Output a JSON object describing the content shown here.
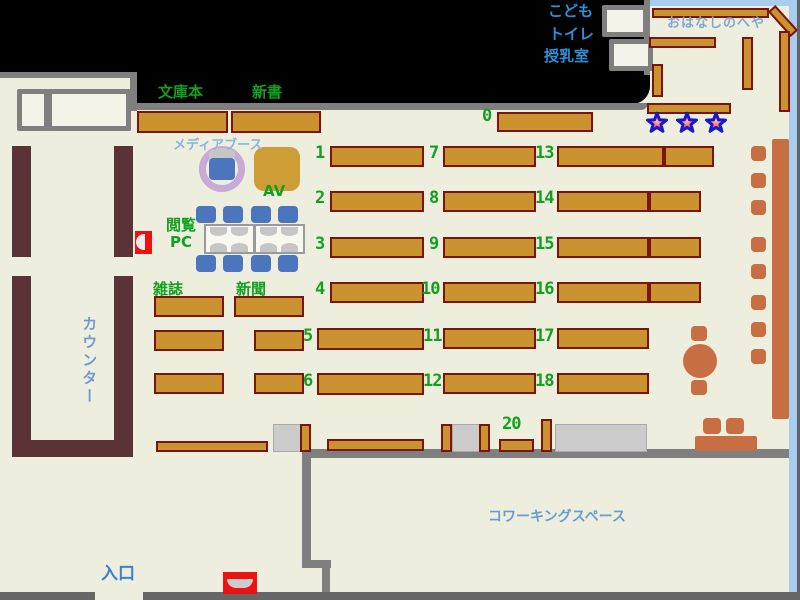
{
  "title": "library-floor-map",
  "colors": {
    "floor": "#eeeede",
    "outside": "#000000",
    "wall_gray": "#7f7f7f",
    "wall_dark": "#666666",
    "story_border_blue": "#a9cdee",
    "shelf_fill": "#ca9330",
    "shelf_border": "#7a150c",
    "counter_maroon": "#5b3336",
    "terracotta": "#c76f42",
    "chair_blue": "#4b76bd",
    "label_green": "#12a01f",
    "label_blue": "#3c7fd8",
    "label_midblue": "#6b9bd2",
    "label_story": "#7fa8d0",
    "label_toilet": "#2f8fd6",
    "media_ring_purple": "#c9a9d6",
    "red_box": "#ee1111",
    "star_fill": "#dd2233",
    "star_stroke": "#1818cc",
    "gray_box": "#cbcbcb"
  },
  "labels": [
    {
      "name": "label-kodomo",
      "text": "こども",
      "x": 548,
      "y": 3,
      "cls": "tblue"
    },
    {
      "name": "label-toilet",
      "text": "トイレ",
      "x": 549,
      "y": 26,
      "cls": "tblue"
    },
    {
      "name": "label-nursing-room",
      "text": "授乳室",
      "x": 544,
      "y": 48,
      "cls": "tblue"
    },
    {
      "name": "label-story-room",
      "text": "おはなしのへや",
      "x": 667,
      "y": 17,
      "cls": "story"
    },
    {
      "name": "label-paperbacks",
      "text": "文庫本",
      "x": 158,
      "y": 84,
      "cls": "green"
    },
    {
      "name": "label-new-books",
      "text": "新書",
      "x": 252,
      "y": 84,
      "cls": "green"
    },
    {
      "name": "label-media-booth",
      "text": "メディアブース",
      "x": 173,
      "y": 139,
      "cls": "media"
    },
    {
      "name": "label-av",
      "text": "AV",
      "x": 263,
      "y": 183,
      "cls": "green"
    },
    {
      "name": "label-browsing-pc",
      "text": "閲覧\nPC",
      "x": 166,
      "y": 217,
      "cls": "green pcl"
    },
    {
      "name": "label-magazines",
      "text": "雑誌",
      "x": 153,
      "y": 281,
      "cls": "green"
    },
    {
      "name": "label-newspapers",
      "text": "新聞",
      "x": 236,
      "y": 281,
      "cls": "green"
    },
    {
      "name": "label-counter",
      "text": "カウンター",
      "x": 80,
      "y": 316,
      "cls": "mblue vert",
      "size": 15
    },
    {
      "name": "label-entrance",
      "text": "入口",
      "x": 101,
      "y": 565,
      "cls": "blue big"
    },
    {
      "name": "label-coworking",
      "text": "コワーキングスペース",
      "x": 488,
      "y": 509,
      "cls": "mblue",
      "size": 14
    }
  ],
  "shelf_numbers": [
    {
      "n": "0",
      "x": 482,
      "y": 106
    },
    {
      "n": "1",
      "x": 315,
      "y": 143
    },
    {
      "n": "2",
      "x": 315,
      "y": 188
    },
    {
      "n": "3",
      "x": 315,
      "y": 234
    },
    {
      "n": "4",
      "x": 315,
      "y": 279
    },
    {
      "n": "5",
      "x": 303,
      "y": 326
    },
    {
      "n": "6",
      "x": 303,
      "y": 371
    },
    {
      "n": "7",
      "x": 429,
      "y": 143
    },
    {
      "n": "8",
      "x": 429,
      "y": 188
    },
    {
      "n": "9",
      "x": 429,
      "y": 234
    },
    {
      "n": "10",
      "x": 421,
      "y": 279
    },
    {
      "n": "11",
      "x": 423,
      "y": 326
    },
    {
      "n": "12",
      "x": 423,
      "y": 371
    },
    {
      "n": "13",
      "x": 535,
      "y": 143
    },
    {
      "n": "14",
      "x": 535,
      "y": 188
    },
    {
      "n": "15",
      "x": 535,
      "y": 234
    },
    {
      "n": "16",
      "x": 535,
      "y": 279
    },
    {
      "n": "17",
      "x": 535,
      "y": 326
    },
    {
      "n": "18",
      "x": 535,
      "y": 371
    },
    {
      "n": "20",
      "x": 502,
      "y": 414
    }
  ],
  "map_shapes": {
    "gold_shelves": [
      {
        "x": 137,
        "y": 111,
        "w": 91,
        "h": 22
      },
      {
        "x": 231,
        "y": 111,
        "w": 90,
        "h": 22
      },
      {
        "x": 497,
        "y": 112,
        "w": 96,
        "h": 20
      },
      {
        "x": 330,
        "y": 146,
        "w": 94,
        "h": 21
      },
      {
        "x": 330,
        "y": 191,
        "w": 94,
        "h": 21
      },
      {
        "x": 330,
        "y": 237,
        "w": 94,
        "h": 21
      },
      {
        "x": 330,
        "y": 282,
        "w": 94,
        "h": 21
      },
      {
        "x": 317,
        "y": 328,
        "w": 107,
        "h": 22
      },
      {
        "x": 317,
        "y": 373,
        "w": 107,
        "h": 22
      },
      {
        "x": 443,
        "y": 146,
        "w": 93,
        "h": 21
      },
      {
        "x": 443,
        "y": 191,
        "w": 93,
        "h": 21
      },
      {
        "x": 443,
        "y": 237,
        "w": 93,
        "h": 21
      },
      {
        "x": 443,
        "y": 282,
        "w": 93,
        "h": 21
      },
      {
        "x": 443,
        "y": 328,
        "w": 93,
        "h": 21
      },
      {
        "x": 443,
        "y": 373,
        "w": 93,
        "h": 21
      },
      {
        "x": 557,
        "y": 146,
        "w": 107,
        "h": 21
      },
      {
        "x": 664,
        "y": 146,
        "w": 50,
        "h": 21
      },
      {
        "x": 557,
        "y": 191,
        "w": 92,
        "h": 21
      },
      {
        "x": 649,
        "y": 191,
        "w": 52,
        "h": 21
      },
      {
        "x": 557,
        "y": 237,
        "w": 92,
        "h": 21
      },
      {
        "x": 649,
        "y": 237,
        "w": 52,
        "h": 21
      },
      {
        "x": 557,
        "y": 282,
        "w": 92,
        "h": 21
      },
      {
        "x": 649,
        "y": 282,
        "w": 52,
        "h": 21
      },
      {
        "x": 557,
        "y": 328,
        "w": 92,
        "h": 21
      },
      {
        "x": 557,
        "y": 373,
        "w": 92,
        "h": 21
      },
      {
        "x": 154,
        "y": 296,
        "w": 70,
        "h": 21
      },
      {
        "x": 154,
        "y": 330,
        "w": 70,
        "h": 21
      },
      {
        "x": 154,
        "y": 373,
        "w": 70,
        "h": 21
      },
      {
        "x": 234,
        "y": 296,
        "w": 70,
        "h": 21
      },
      {
        "x": 254,
        "y": 330,
        "w": 50,
        "h": 21
      },
      {
        "x": 254,
        "y": 373,
        "w": 50,
        "h": 21
      },
      {
        "x": 156,
        "y": 441,
        "w": 112,
        "h": 11
      },
      {
        "x": 327,
        "y": 439,
        "w": 97,
        "h": 12
      },
      {
        "x": 499,
        "y": 439,
        "w": 35,
        "h": 13
      },
      {
        "x": 300,
        "y": 424,
        "w": 11,
        "h": 28
      },
      {
        "x": 441,
        "y": 424,
        "w": 11,
        "h": 28
      },
      {
        "x": 479,
        "y": 424,
        "w": 11,
        "h": 28
      },
      {
        "x": 541,
        "y": 419,
        "w": 11,
        "h": 33
      },
      {
        "x": 652,
        "y": 8,
        "w": 117,
        "h": 10
      },
      {
        "x": 766,
        "y": 16,
        "w": 34,
        "h": 10,
        "rot": 48
      },
      {
        "x": 649,
        "y": 37,
        "w": 67,
        "h": 11
      },
      {
        "x": 742,
        "y": 37,
        "w": 11,
        "h": 53
      },
      {
        "x": 779,
        "y": 31,
        "w": 11,
        "h": 81
      },
      {
        "x": 652,
        "y": 64,
        "w": 11,
        "h": 33
      },
      {
        "x": 647,
        "y": 103,
        "w": 84,
        "h": 11
      }
    ],
    "counter_bars": [
      {
        "x": 12,
        "y": 146,
        "w": 19,
        "h": 111
      },
      {
        "x": 114,
        "y": 146,
        "w": 19,
        "h": 111
      },
      {
        "x": 12,
        "y": 276,
        "w": 19,
        "h": 181
      },
      {
        "x": 114,
        "y": 276,
        "w": 19,
        "h": 166
      },
      {
        "x": 12,
        "y": 440,
        "w": 121,
        "h": 17
      }
    ],
    "gray_boxes": [
      {
        "x": 273,
        "y": 424,
        "w": 28,
        "h": 28
      },
      {
        "x": 452,
        "y": 424,
        "w": 28,
        "h": 28
      },
      {
        "x": 555,
        "y": 424,
        "w": 92,
        "h": 28
      }
    ],
    "white_boxes": [
      {
        "x": 17,
        "y": 89,
        "w": 32,
        "h": 42
      },
      {
        "x": 47,
        "y": 89,
        "w": 84,
        "h": 42
      },
      {
        "x": 602,
        "y": 5,
        "w": 46,
        "h": 32
      },
      {
        "x": 609,
        "y": 39,
        "w": 44,
        "h": 32
      }
    ],
    "terracotta": {
      "window_bar": {
        "x": 772,
        "y": 139,
        "w": 17,
        "h": 280
      },
      "window_chairs_x": 751,
      "window_chairs_y": [
        146,
        173,
        200,
        237,
        264,
        295,
        322,
        349
      ],
      "round_table": {
        "x": 683,
        "y": 344,
        "w": 34,
        "h": 34
      },
      "round_table_chairs": [
        {
          "x": 691,
          "y": 326,
          "w": 16,
          "h": 15
        },
        {
          "x": 691,
          "y": 380,
          "w": 16,
          "h": 15
        }
      ],
      "corner_chairs": [
        {
          "x": 703,
          "y": 418,
          "w": 18,
          "h": 16
        },
        {
          "x": 726,
          "y": 418,
          "w": 18,
          "h": 16
        }
      ],
      "corner_bench": {
        "x": 695,
        "y": 436,
        "w": 62,
        "h": 15
      }
    },
    "pc_area": {
      "tables": [
        {
          "x": 204,
          "y": 224,
          "w": 51,
          "h": 30
        },
        {
          "x": 254,
          "y": 224,
          "w": 51,
          "h": 30
        }
      ],
      "monitor_xs": [
        210,
        231,
        260,
        281
      ],
      "monitor_rows": [
        {
          "y": 227,
          "dir": "d"
        },
        {
          "y": 243,
          "dir": "u"
        }
      ],
      "chair_xs": [
        196,
        223,
        251,
        278
      ],
      "chair_rows": [
        206,
        255
      ]
    },
    "media_booth": {
      "ring": {
        "x": 199,
        "y": 146,
        "w": 46,
        "h": 46
      },
      "monitor": {
        "x": 209,
        "y": 148,
        "w": 26,
        "h": 10
      },
      "chair": {
        "x": 209,
        "y": 158,
        "w": 26,
        "h": 22
      }
    },
    "av_table": {
      "x": 254,
      "y": 147,
      "w": 46,
      "h": 44
    },
    "red_boxes": [
      {
        "x": 135,
        "y": 231,
        "w": 17,
        "h": 23,
        "shape": "half-left"
      },
      {
        "x": 223,
        "y": 572,
        "w": 34,
        "h": 22,
        "shape": "bowl"
      }
    ],
    "stars": {
      "y": 111,
      "xs": [
        645,
        675,
        704
      ],
      "size": 24
    },
    "walls": {
      "black_band": {
        "x": 0,
        "y": 0,
        "w": 650,
        "h": 104
      },
      "left_room_floor": {
        "x": 0,
        "y": 78,
        "w": 130,
        "h": 33
      },
      "story_floor": {
        "x": 650,
        "y": 6,
        "w": 140,
        "h": 104
      },
      "top_left_h": {
        "x": 0,
        "y": 72,
        "w": 137,
        "h": 6
      },
      "top_left_v": {
        "x": 130,
        "y": 72,
        "w": 7,
        "h": 39
      },
      "top_long": {
        "x": 130,
        "y": 103,
        "w": 518,
        "h": 7
      },
      "story_edge": {
        "x": 644,
        "y": 0,
        "w": 6,
        "h": 75
      },
      "blue_top": {
        "x": 650,
        "y": 0,
        "w": 147,
        "h": 6
      },
      "blue_right": {
        "x": 789,
        "y": 0,
        "w": 8,
        "h": 592
      },
      "right_edge": {
        "x": 797,
        "y": 0,
        "w": 3,
        "h": 600
      },
      "cowork_h": {
        "x": 302,
        "y": 449,
        "w": 487,
        "h": 9
      },
      "cowork_v": {
        "x": 302,
        "y": 449,
        "w": 9,
        "h": 119
      },
      "cowork_jog": {
        "x": 302,
        "y": 560,
        "w": 29,
        "h": 8
      },
      "cowork_v2": {
        "x": 322,
        "y": 560,
        "w": 8,
        "h": 33
      },
      "bottom_left": {
        "x": 0,
        "y": 592,
        "w": 95,
        "h": 8
      },
      "bottom_right": {
        "x": 143,
        "y": 592,
        "w": 657,
        "h": 8
      }
    }
  }
}
